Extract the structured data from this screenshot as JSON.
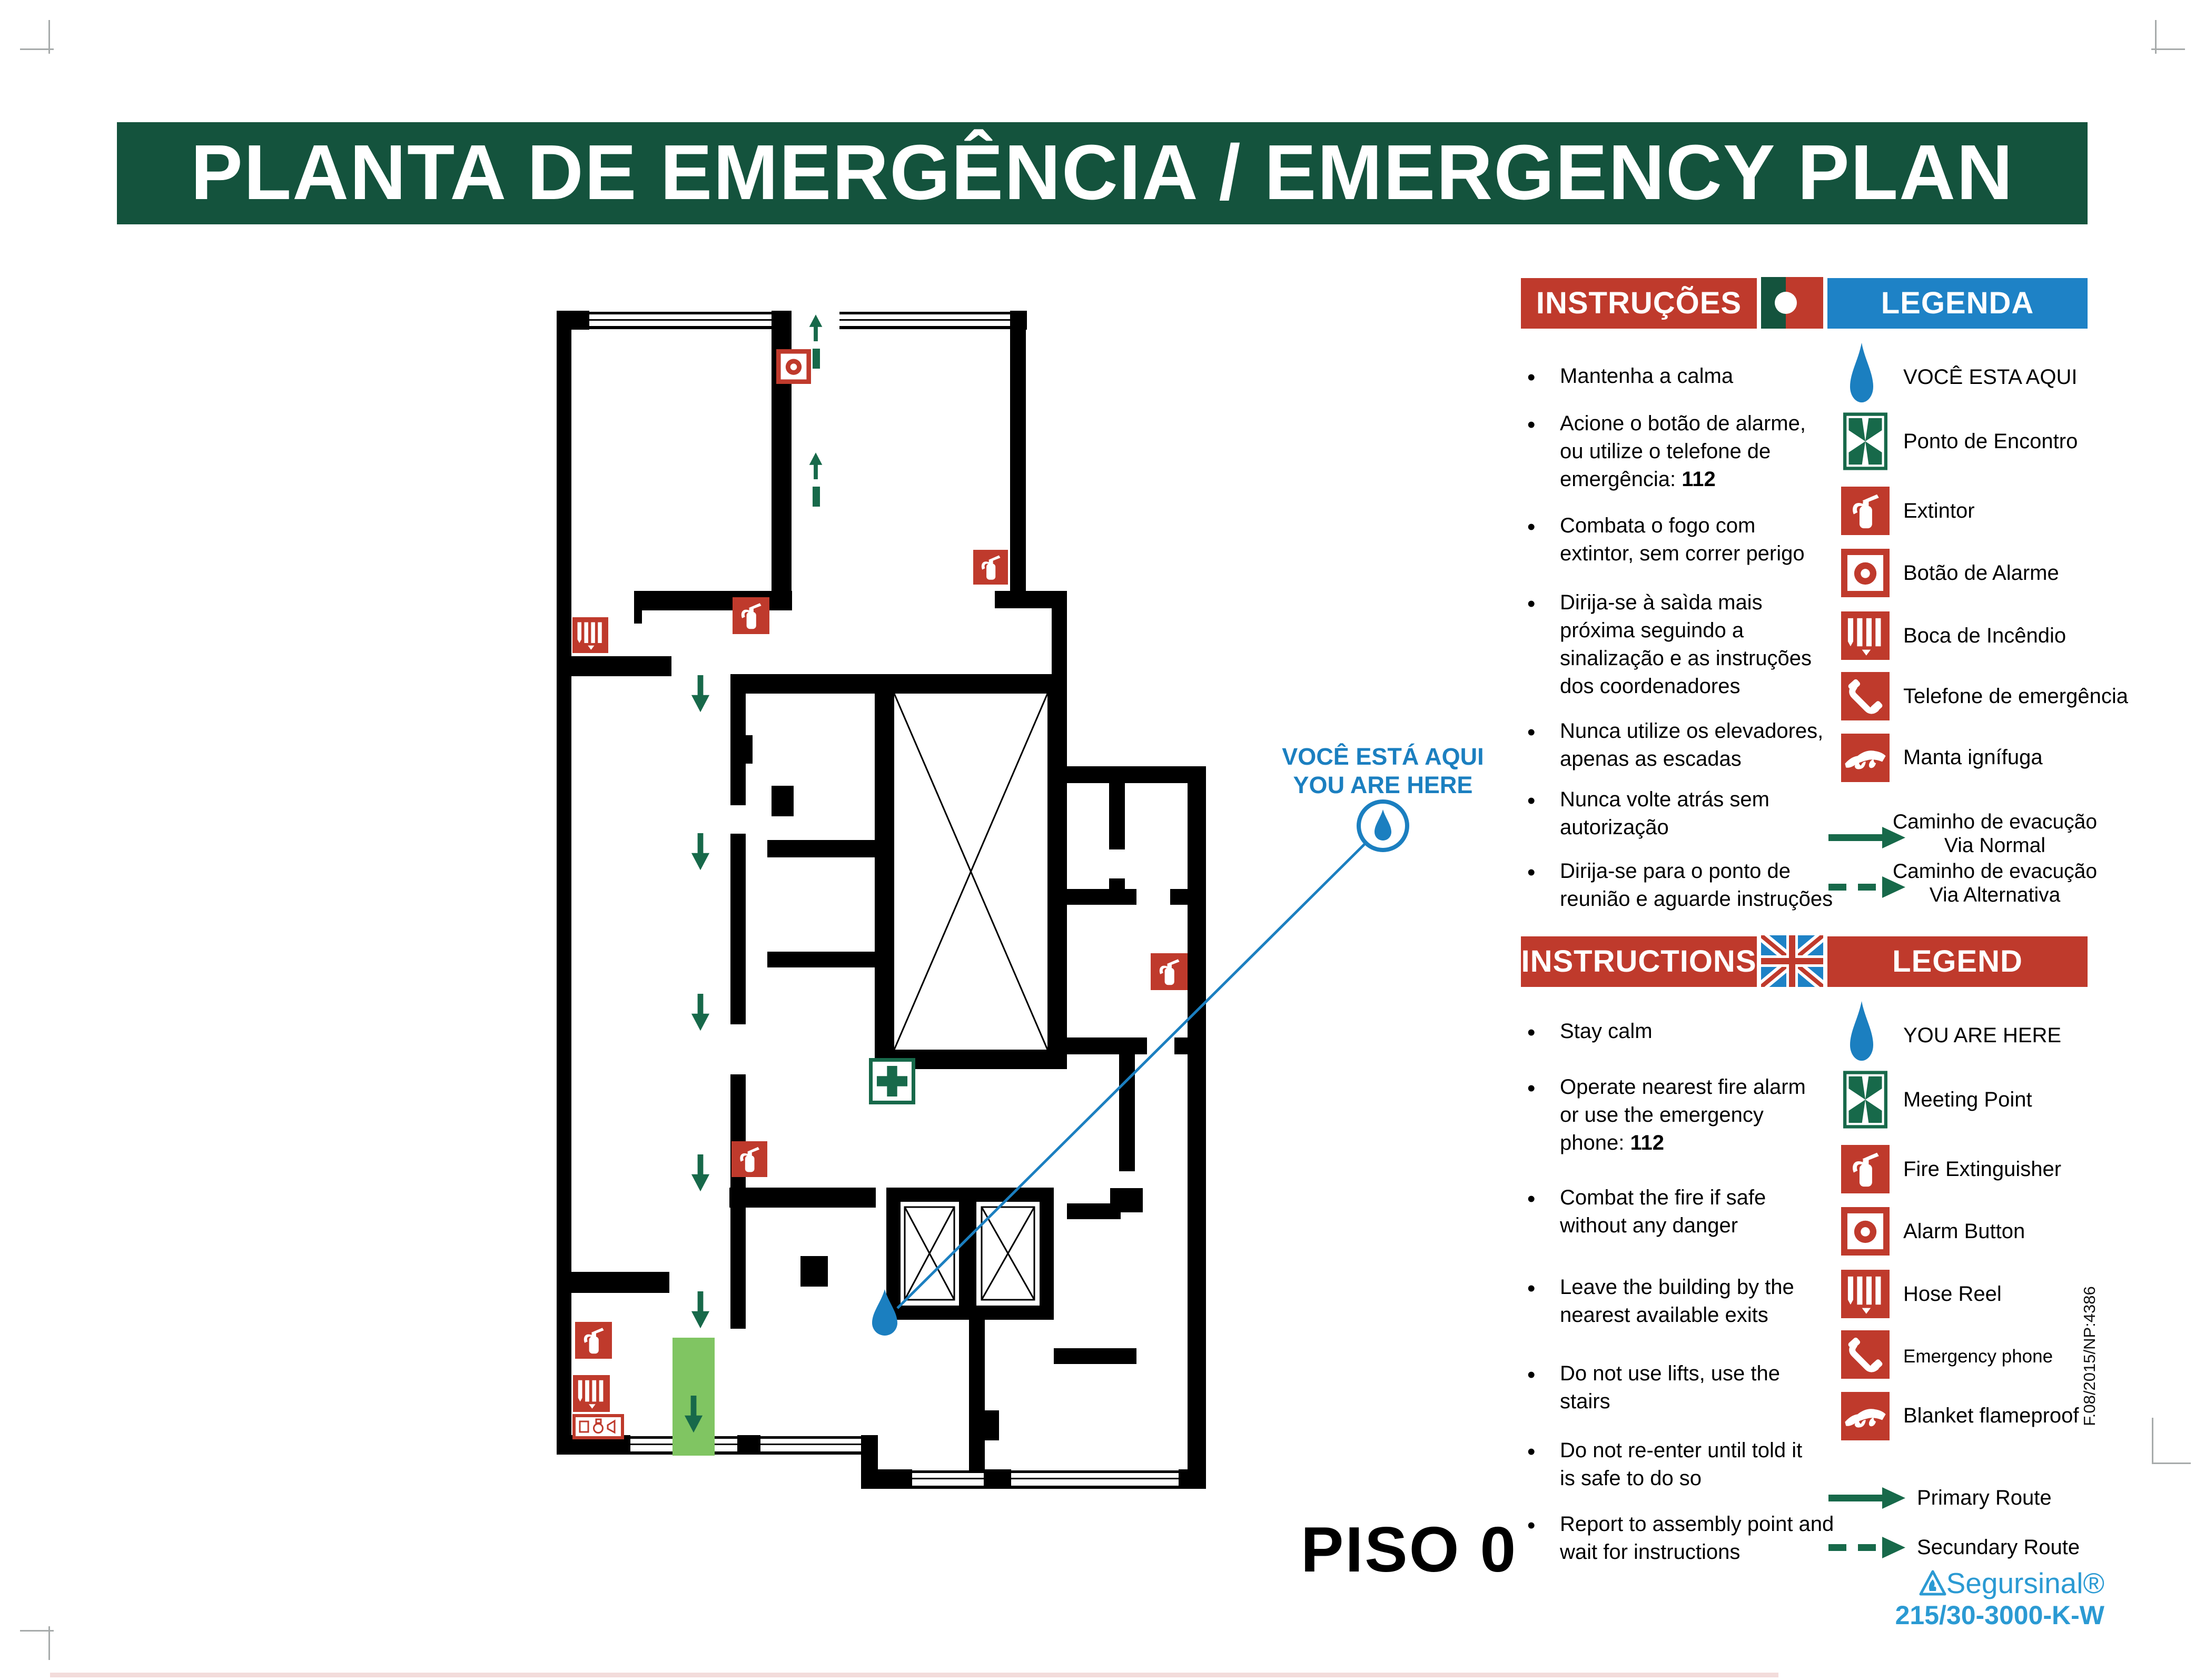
{
  "title": "PLANTA DE EMERGÊNCIA / EMERGENCY PLAN",
  "floor_label": "PISO 0",
  "map": {
    "you_are_here_pt": "VOCÊ ESTÁ AQUI",
    "you_are_here_en": "YOU ARE HERE",
    "features": [
      "stairwell",
      "elevators",
      "exit-strip",
      "evacuation-arrows",
      "you-are-here-marker"
    ]
  },
  "pt": {
    "instructions_header": "INSTRUÇÕES",
    "legend_header": "LEGENDA",
    "flag": "portugal-flag",
    "instructions": [
      {
        "lines": [
          "Mantenha a calma"
        ]
      },
      {
        "lines": [
          "Acione o botão de alarme,",
          "ou utilize o telefone de"
        ],
        "tail": "emergência: ",
        "tail_bold": "112"
      },
      {
        "lines": [
          "Combata o fogo com",
          "extintor, sem correr perigo"
        ]
      },
      {
        "lines": [
          "Dirija-se à saìda mais",
          "próxima seguindo a",
          "sinalização e as instruções",
          "dos coordenadores"
        ]
      },
      {
        "lines": [
          "Nunca utilize os elevadores,",
          "apenas as escadas"
        ]
      },
      {
        "lines": [
          "Nunca volte atrás sem",
          "autorização"
        ]
      },
      {
        "lines": [
          "Dirija-se para o ponto de",
          "reunião e aguarde instruções"
        ]
      }
    ],
    "legend": [
      {
        "icon": "you-are-here-drop",
        "label": "VOCÊ ESTA AQUI"
      },
      {
        "icon": "meeting-point",
        "label": "Ponto de Encontro"
      },
      {
        "icon": "fire-extinguisher",
        "label": "Extintor"
      },
      {
        "icon": "alarm-button",
        "label": "Botão de Alarme"
      },
      {
        "icon": "hose-reel",
        "label": "Boca de Incêndio"
      },
      {
        "icon": "emergency-phone",
        "label": "Telefone de emergência"
      },
      {
        "icon": "fire-blanket",
        "label": "Manta ignífuga"
      },
      {
        "icon": "route-solid-arrow",
        "label": "Caminho de evacução",
        "label2": "Via Normal"
      },
      {
        "icon": "route-dashed-arrow",
        "label": "Caminho de evacução",
        "label2": "Via Alternativa"
      }
    ]
  },
  "en": {
    "instructions_header": "INSTRUCTIONS",
    "legend_header": "LEGEND",
    "flag": "uk-flag",
    "instructions": [
      {
        "lines": [
          "Stay calm"
        ]
      },
      {
        "lines": [
          "Operate nearest fire alarm",
          "or use the emergency"
        ],
        "tail": "phone: ",
        "tail_bold": "112"
      },
      {
        "lines": [
          "Combat the fire if safe",
          "without any danger"
        ]
      },
      {
        "lines": [
          "Leave the building by the",
          "nearest available exits"
        ]
      },
      {
        "lines": [
          "Do not use lifts, use the",
          "stairs"
        ]
      },
      {
        "lines": [
          "Do not re-enter until told it",
          "is safe to do so"
        ]
      },
      {
        "lines": [
          "Report to assembly point and",
          "wait for instructions"
        ]
      }
    ],
    "legend": [
      {
        "icon": "you-are-here-drop",
        "label": "YOU ARE HERE"
      },
      {
        "icon": "meeting-point",
        "label": "Meeting Point"
      },
      {
        "icon": "fire-extinguisher",
        "label": "Fire Extinguisher"
      },
      {
        "icon": "alarm-button",
        "label": "Alarm Button"
      },
      {
        "icon": "hose-reel",
        "label": "Hose Reel"
      },
      {
        "icon": "emergency-phone",
        "label": "Emergency phone"
      },
      {
        "icon": "fire-blanket",
        "label": "Blanket flameproof"
      },
      {
        "icon": "route-solid-arrow",
        "label": "Primary Route"
      },
      {
        "icon": "route-dashed-arrow",
        "label": "Secundary Route"
      }
    ]
  },
  "footer": {
    "brand": "Segursinal®",
    "model": "215/30-3000-K-W",
    "doc_ref": "F.08/2015/NP:4386"
  },
  "colors": {
    "banner_green": "#14533d",
    "header_red": "#bf3a2c",
    "header_blue": "#1e82c6",
    "icon_red": "#bf3a2c",
    "route_green": "#17694a",
    "exit_strip_green": "#80c562",
    "marker_blue": "#1b7fc0",
    "brand_blue": "#2b9ad3"
  }
}
